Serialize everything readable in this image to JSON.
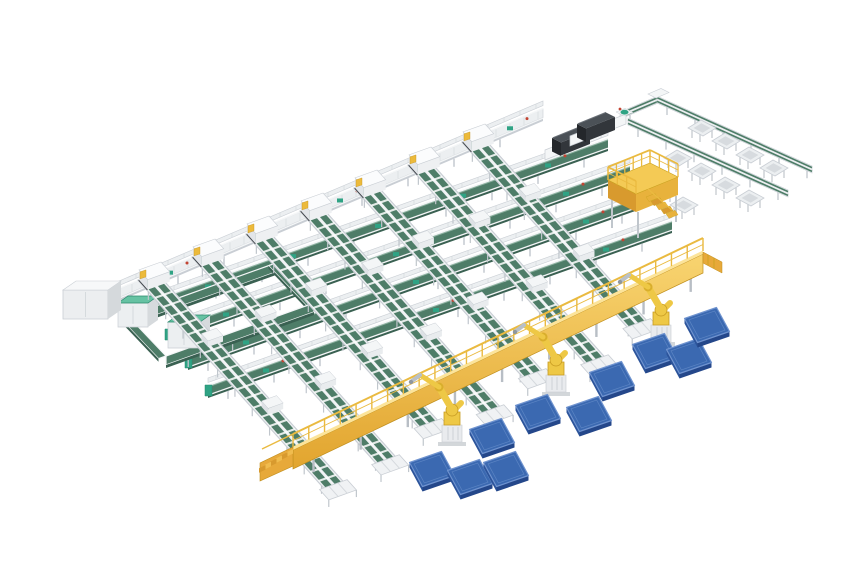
{
  "canvas": {
    "width": 860,
    "height": 580,
    "background": "#ffffff"
  },
  "palette": {
    "background": "#ffffff",
    "belt_green": "#4e7d68",
    "belt_green_dark": "#3a6152",
    "belt_green_light": "#8fb3a2",
    "teal_accent": "#2fa384",
    "teal_top": "#66c2a3",
    "frame_white": "#f4f6f7",
    "frame_light": "#eceff1",
    "frame_mid": "#c9ced4",
    "frame_dark": "#aab1b8",
    "leg_gray": "#c0c6cc",
    "walkway_top": "#fce49a",
    "walkway_face_hi": "#f8d470",
    "walkway_face_lo": "#e2a52f",
    "walkway_edge": "#c08f1d",
    "walkway_rail": "#eaba40",
    "robot_yellow": "#eec845",
    "robot_yellow_dark": "#c79b22",
    "robot_gray": "#e9ebee",
    "pallet_top": "#3b69b1",
    "pallet_side": "#24478a",
    "pallet_side2": "#2c549b",
    "pallet_edge": "#6f93cf",
    "machine_top": "#4b5157",
    "machine_side": "#32363b",
    "machine_front": "#24272b",
    "accent_red": "#c24432",
    "accent_yellow_tab": "#ecba3b"
  },
  "scene": {
    "aria_label": "Isometric 3D render of an automated parcel sortation plant: seven inclined sorter conveyors with green belts, four green cross conveyors, an infeed loop with buffer machines, two dark scanner machines, a yellow service platform, an elevated yellow walkway with stairs, three yellow palletizing robots and blue floor pallets, and a takeaway line with gray discharge trays",
    "counts": {
      "sorter_lines": 7,
      "cross_conveyors": 4,
      "palletizing_robots": 3,
      "pallets": 10,
      "discharge_trays": 10,
      "scanner_machines": 2,
      "service_platforms": 1,
      "buffer_machines": 2
    },
    "cabinet": {
      "x": 63,
      "y": 290,
      "w": 45,
      "h": 29
    },
    "infeed_loop": {
      "a": [
        128,
        316
      ],
      "b": [
        276,
        263
      ],
      "c": [
        314,
        303
      ],
      "d": [
        166,
        356
      ]
    },
    "green_top_machines": [
      [
        118,
        303,
        30,
        24
      ],
      [
        168,
        322,
        32,
        26
      ]
    ],
    "main_line": {
      "x1": 112,
      "y1": 292,
      "x2": 543,
      "y2": 109
    },
    "cross_conveyors": [
      {
        "x1": 150,
        "y1": 302,
        "x2": 608,
        "y2": 139
      },
      {
        "x1": 168,
        "y1": 330,
        "x2": 630,
        "y2": 166
      },
      {
        "x1": 188,
        "y1": 358,
        "x2": 652,
        "y2": 193
      },
      {
        "x1": 208,
        "y1": 386,
        "x2": 672,
        "y2": 221
      }
    ],
    "sorter_heads": [
      [
        157,
        273
      ],
      [
        211,
        250
      ],
      [
        265,
        227
      ],
      [
        319,
        204
      ],
      [
        373,
        181
      ],
      [
        427,
        158
      ],
      [
        481,
        135
      ]
    ],
    "sorter_geometry": {
      "slope": 1.12,
      "width": 21,
      "robot_lines": [
        2,
        4,
        6
      ],
      "ext_robot": 40,
      "ext_plain": 55
    },
    "walkway": {
      "x1": 293,
      "y1": 450,
      "x2": 703,
      "y2": 254,
      "wall_h": 19,
      "rail_h": 13
    },
    "scanner_machines": [
      [
        545,
        150
      ],
      [
        570,
        136
      ]
    ],
    "takeaway_lines": [
      [
        620,
        112,
        658,
        96
      ],
      [
        657,
        96,
        812,
        166
      ],
      [
        628,
        118,
        788,
        190
      ]
    ],
    "discharge_trays": [
      [
        702,
        128
      ],
      [
        726,
        141
      ],
      [
        750,
        155
      ],
      [
        774,
        168
      ],
      [
        678,
        158
      ],
      [
        702,
        171
      ],
      [
        726,
        185
      ],
      [
        750,
        198
      ],
      [
        660,
        192
      ],
      [
        684,
        205
      ]
    ],
    "service_platform": {
      "x": 608,
      "y": 180
    },
    "robots": [
      [
        452,
        439
      ],
      [
        556,
        389
      ],
      [
        661,
        339
      ]
    ],
    "pallets": [
      [
        432,
        469
      ],
      [
        470,
        477
      ],
      [
        506,
        469
      ],
      [
        492,
        436
      ],
      [
        538,
        412
      ],
      [
        589,
        414
      ],
      [
        612,
        379
      ],
      [
        655,
        351
      ],
      [
        689,
        356
      ],
      [
        707,
        325
      ]
    ]
  }
}
